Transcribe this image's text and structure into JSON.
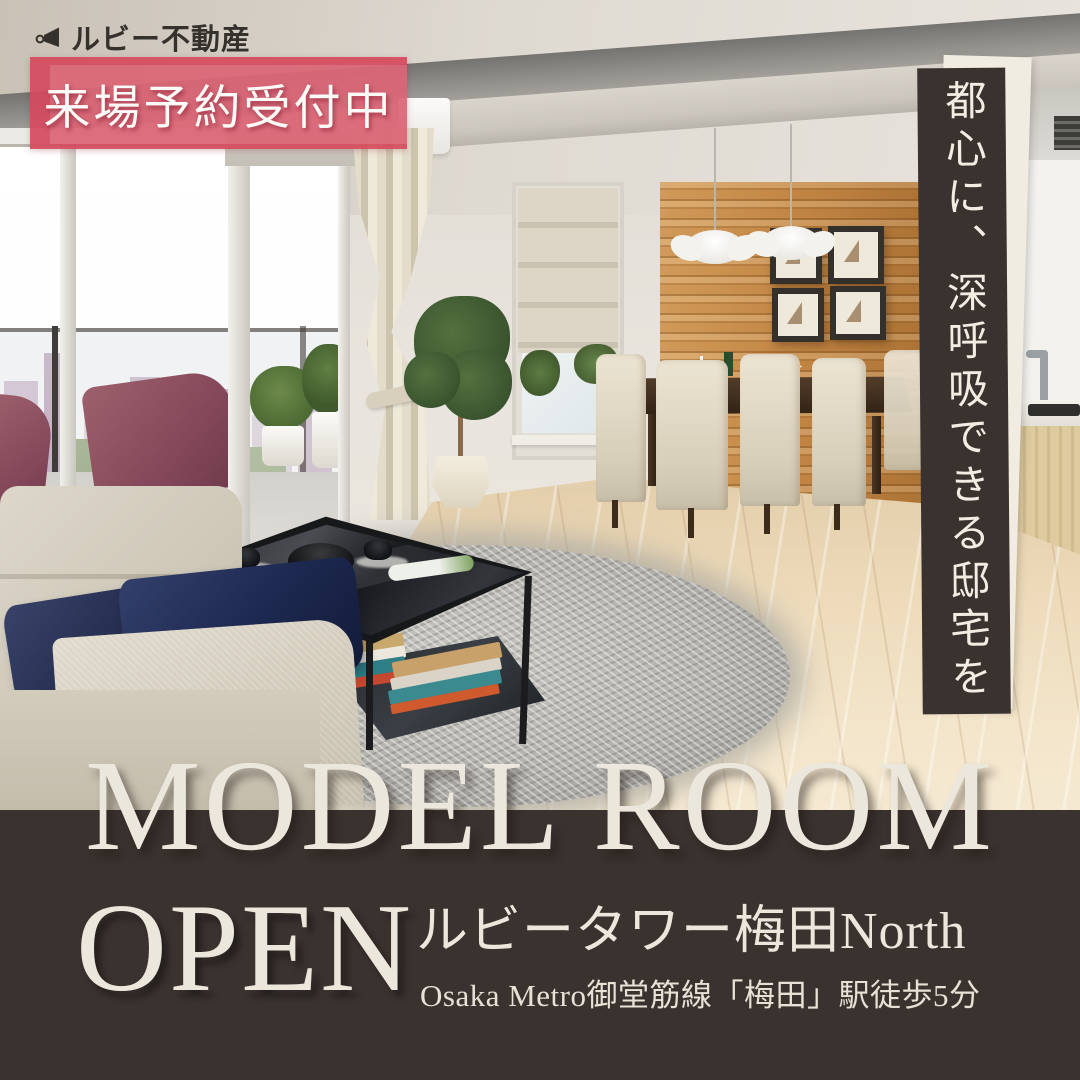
{
  "brand": {
    "name": "ルビー不動産"
  },
  "reservation_banner": {
    "label": "来場予約受付中"
  },
  "vertical_tagline": {
    "text": "都心に、深呼吸できる邸宅を"
  },
  "headline": {
    "line1": "MODEL ROOM",
    "line2": "OPEN"
  },
  "property": {
    "name": "ルビータワー梅田North",
    "access": "Osaka Metro御堂筋線「梅田」駅徒歩5分"
  },
  "colors": {
    "accent_pink": "#d54a5d",
    "band_dark": "#3a322f",
    "text_cream": "#ece7dd"
  }
}
